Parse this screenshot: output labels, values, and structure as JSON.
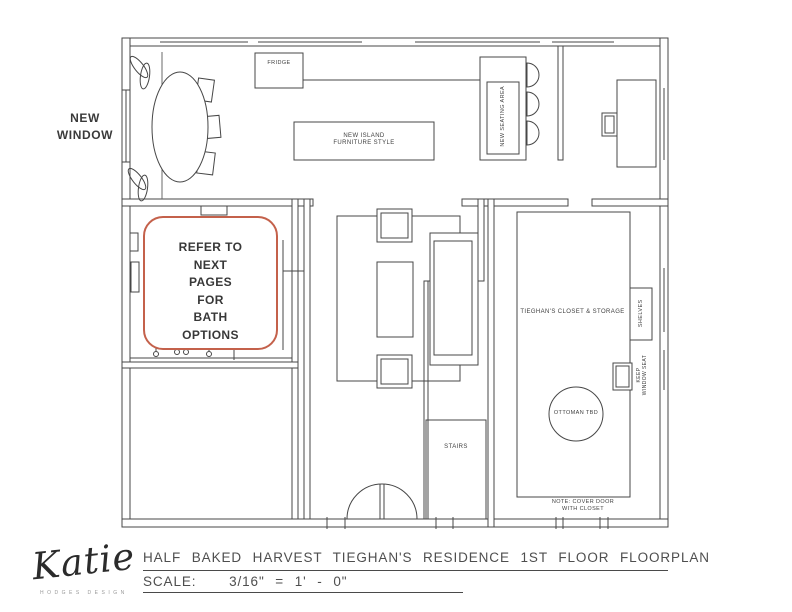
{
  "plan": {
    "labels": {
      "new_window": "NEW WINDOW",
      "fridge": "FRIDGE",
      "island_line1": "NEW ISLAND",
      "island_line2": "FURNITURE STYLE",
      "seating_area": "NEW SEATING AREA",
      "closet": "TIEGHAN'S CLOSET & STORAGE",
      "shelves": "SHELVES",
      "window_seat_line1": "KEEP",
      "window_seat_line2": "WINDOW SEAT",
      "ottoman": "OTTOMAN TBD",
      "stairs": "STAIRS",
      "note_line1": "NOTE: COVER DOOR",
      "note_line2": "WITH CLOSET"
    },
    "callout": {
      "lines": [
        "REFER TO",
        "NEXT",
        "PAGES",
        "FOR",
        "BATH",
        "OPTIONS"
      ],
      "border_color": "#c4614b"
    }
  },
  "titleblock": {
    "logo_script": "Katie",
    "logo_sub": "HODGES DESIGN",
    "title": "HALF BAKED HARVEST TIEGHAN'S RESIDENCE 1ST FLOOR FLOORPLAN",
    "scale_label": "SCALE:",
    "scale_value": "3/16\" = 1' - 0\""
  },
  "colors": {
    "line": "#474747",
    "callout_border": "#c4614b",
    "text": "#3d3d3d"
  }
}
